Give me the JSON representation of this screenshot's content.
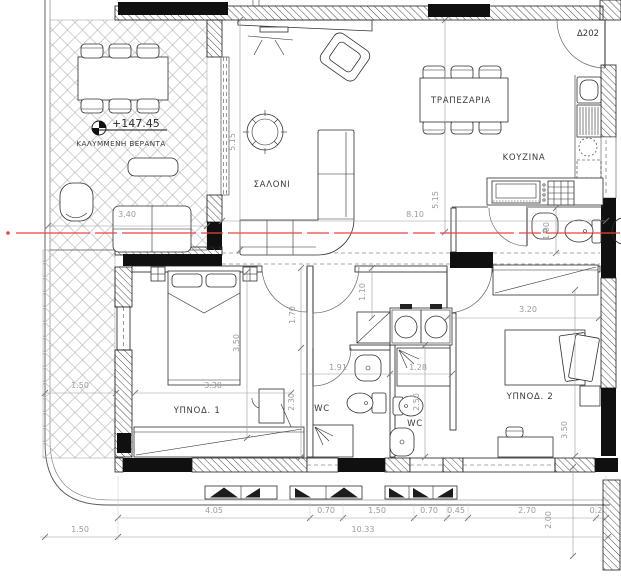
{
  "plan": {
    "apartment_label": "Δ202",
    "elevation_label": "+147.45",
    "rooms": {
      "veranda": "ΚΑΛΥΜΜΕΝΗ ΒΕΡΑΝΤΑ",
      "living_room": "ΣΑΛΟΝΙ",
      "dining_room": "ΤΡΑΠΕΖΑΡΙΑ",
      "kitchen": "ΚΟΥΖΙΝΑ",
      "bedroom_1": "ΥΠΝΟΔ. 1",
      "bedroom_2": "ΥΠΝΟΔ. 2",
      "wc_1": "WC",
      "wc_2": "WC"
    },
    "dims": {
      "veranda_front": "3.40",
      "living_depth": "5.15",
      "dining_depth": "5.15",
      "living_width": "8.10",
      "kitchen_wc": "1.00",
      "hall": "1.10",
      "corridor": "1.70",
      "bed1_depth": "3.50",
      "bed1_width": "3.30",
      "balcony_left": "1.50",
      "wc1_width": "1.91",
      "wc1_depth": "2.30",
      "wc2_width": "1.28",
      "wc2_depth": "2.50",
      "bed2_width": "3.20",
      "bed2_depth": "3.50",
      "bottom_row": [
        "4.05",
        "0.70",
        "1.50",
        "0.70",
        "0.45",
        "2.70",
        "0.2"
      ],
      "bottom_offset": "1.50",
      "bottom_total": "10.33",
      "balcony_depth": "2.00"
    },
    "colors": {
      "section_line": "#ee4338",
      "wall_fill": "#101010",
      "dim_text": "#9b9b9b"
    }
  }
}
